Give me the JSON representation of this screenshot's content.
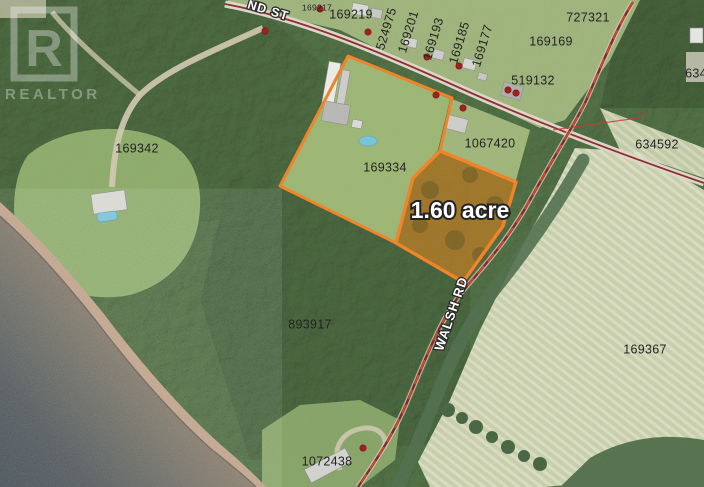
{
  "map": {
    "watermark": {
      "logo_letter": "R",
      "word": "REALTOR"
    },
    "area_label": {
      "text": "1.60 acre",
      "x": 460,
      "y": 212,
      "size": 23
    },
    "road_labels": [
      {
        "text": "ND ST",
        "x": 268,
        "y": 11,
        "rotate": 17,
        "size": 12.5
      },
      {
        "text": "WALSH RD",
        "x": 452,
        "y": 314,
        "rotate": -71,
        "size": 13
      }
    ],
    "parcel_labels": [
      {
        "text": "169217",
        "x": 317,
        "y": 8,
        "rotate": 0,
        "size": 8.5
      },
      {
        "text": "169219",
        "x": 351,
        "y": 15,
        "rotate": 0,
        "size": 12.5
      },
      {
        "text": "524975",
        "x": 387,
        "y": 29,
        "rotate": -73,
        "size": 12.5
      },
      {
        "text": "169201",
        "x": 409,
        "y": 32,
        "rotate": -73,
        "size": 12.5
      },
      {
        "text": "169193",
        "x": 434,
        "y": 39,
        "rotate": -73,
        "size": 12.5
      },
      {
        "text": "169185",
        "x": 460,
        "y": 43,
        "rotate": -73,
        "size": 12.5
      },
      {
        "text": "169177",
        "x": 483,
        "y": 46,
        "rotate": -73,
        "size": 12.5
      },
      {
        "text": "727321",
        "x": 588,
        "y": 18,
        "rotate": 0,
        "size": 12.5
      },
      {
        "text": "169169",
        "x": 551,
        "y": 42,
        "rotate": 0,
        "size": 12.5
      },
      {
        "text": "519132",
        "x": 533,
        "y": 81,
        "rotate": 0,
        "size": 12.5
      },
      {
        "text": "634",
        "x": 696,
        "y": 74,
        "rotate": 0,
        "size": 12.5
      },
      {
        "text": "634592",
        "x": 657,
        "y": 145,
        "rotate": 0,
        "size": 12.5
      },
      {
        "text": "1067420",
        "x": 490,
        "y": 144,
        "rotate": 0,
        "size": 12.5
      },
      {
        "text": "169334",
        "x": 385,
        "y": 168,
        "rotate": 0,
        "size": 12.5
      },
      {
        "text": "169342",
        "x": 137,
        "y": 149,
        "rotate": 0,
        "size": 12.5
      },
      {
        "text": "893917",
        "x": 310,
        "y": 325,
        "rotate": 0,
        "size": 12.5
      },
      {
        "text": "169367",
        "x": 645,
        "y": 350,
        "rotate": 0,
        "size": 12.5
      },
      {
        "text": "1072438",
        "x": 327,
        "y": 462,
        "rotate": 0,
        "size": 12.5
      }
    ],
    "address_points": [
      [
        265,
        31
      ],
      [
        320,
        9
      ],
      [
        368,
        32
      ],
      [
        427,
        57
      ],
      [
        459,
        66
      ],
      [
        436,
        95
      ],
      [
        463,
        108
      ],
      [
        508,
        90
      ],
      [
        516,
        93
      ],
      [
        363,
        448
      ]
    ],
    "colors": {
      "parcel_highlight": "#ef7c1c",
      "parcel_fill_tint": "#e07b10",
      "road_centerline": "#8b2222",
      "road_dash_red": "#d63a20",
      "civic_point": "#9e1111",
      "water_deep": "#3d4950",
      "water_shallow": "#9b8068",
      "label_text": "#141414"
    }
  }
}
